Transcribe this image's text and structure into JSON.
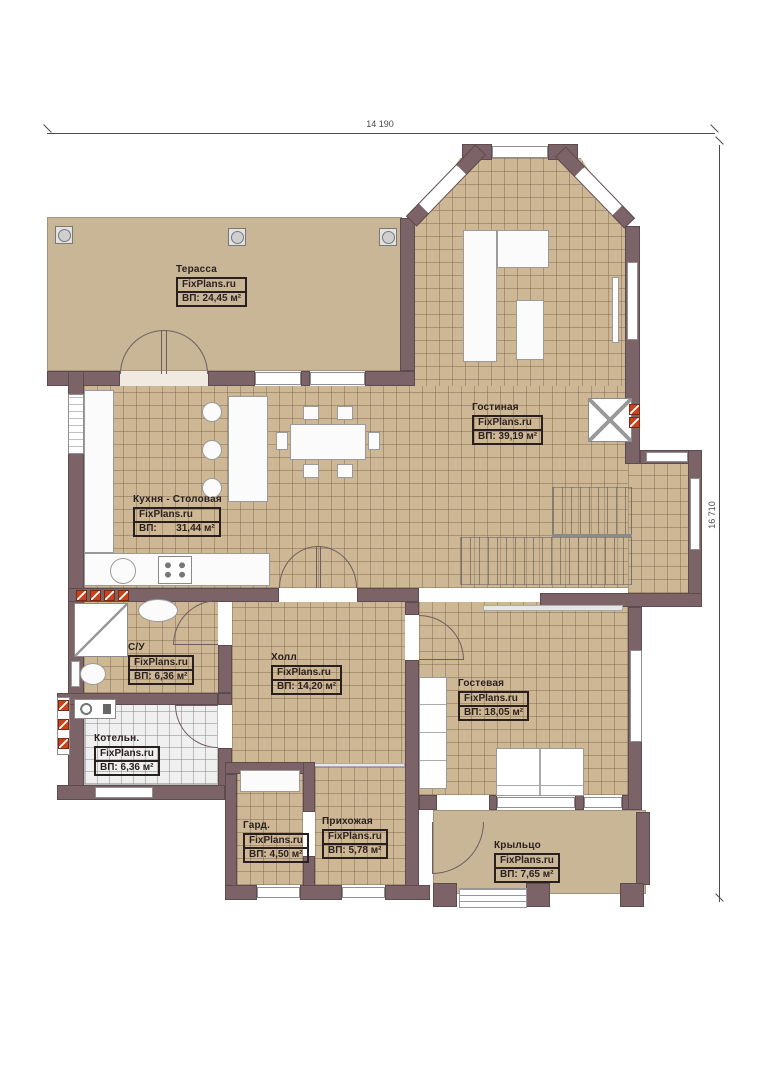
{
  "dimensions": {
    "width_label": "14 190",
    "height_label": "16 710"
  },
  "rooms": {
    "terrace": {
      "name": "Терасса",
      "brand": "FixPlans.ru",
      "area": "ВП: 24,45 м²"
    },
    "living": {
      "name": "Гостиная",
      "brand": "FixPlans.ru",
      "area": "ВП: 39,19 м²"
    },
    "kitchen": {
      "name": "Кухня - Столовая",
      "brand": "FixPlans.ru",
      "area": "ВП:       31,44 м²"
    },
    "bathroom": {
      "name": "С/У",
      "brand": "FixPlans.ru",
      "area": "ВП: 6,36 м²"
    },
    "hall": {
      "name": "Холл",
      "brand": "FixPlans.ru",
      "area": "ВП: 14,20 м²"
    },
    "guest": {
      "name": "Гостевая",
      "brand": "FixPlans.ru",
      "area": "ВП: 18,05 м²"
    },
    "boiler": {
      "name": "Котельн.",
      "brand": "FixPlans.ru",
      "area": "ВП: 6,36 м²"
    },
    "wardrobe": {
      "name": "Гард.",
      "brand": "FixPlans.ru",
      "area": "ВП: 4,50 м²"
    },
    "entry": {
      "name": "Прихожая",
      "brand": "FixPlans.ru",
      "area": "ВП: 5,78 м²"
    },
    "porch": {
      "name": "Крыльцо",
      "brand": "FixPlans.ru",
      "area": "ВП: 7,65 м²"
    }
  },
  "colors": {
    "wall": "#7b6367",
    "floor_tile": "#cdb795",
    "terrace_floor": "#c9b697",
    "radiator_marker": "#c8431c",
    "label_text": "#2a1f1f"
  }
}
